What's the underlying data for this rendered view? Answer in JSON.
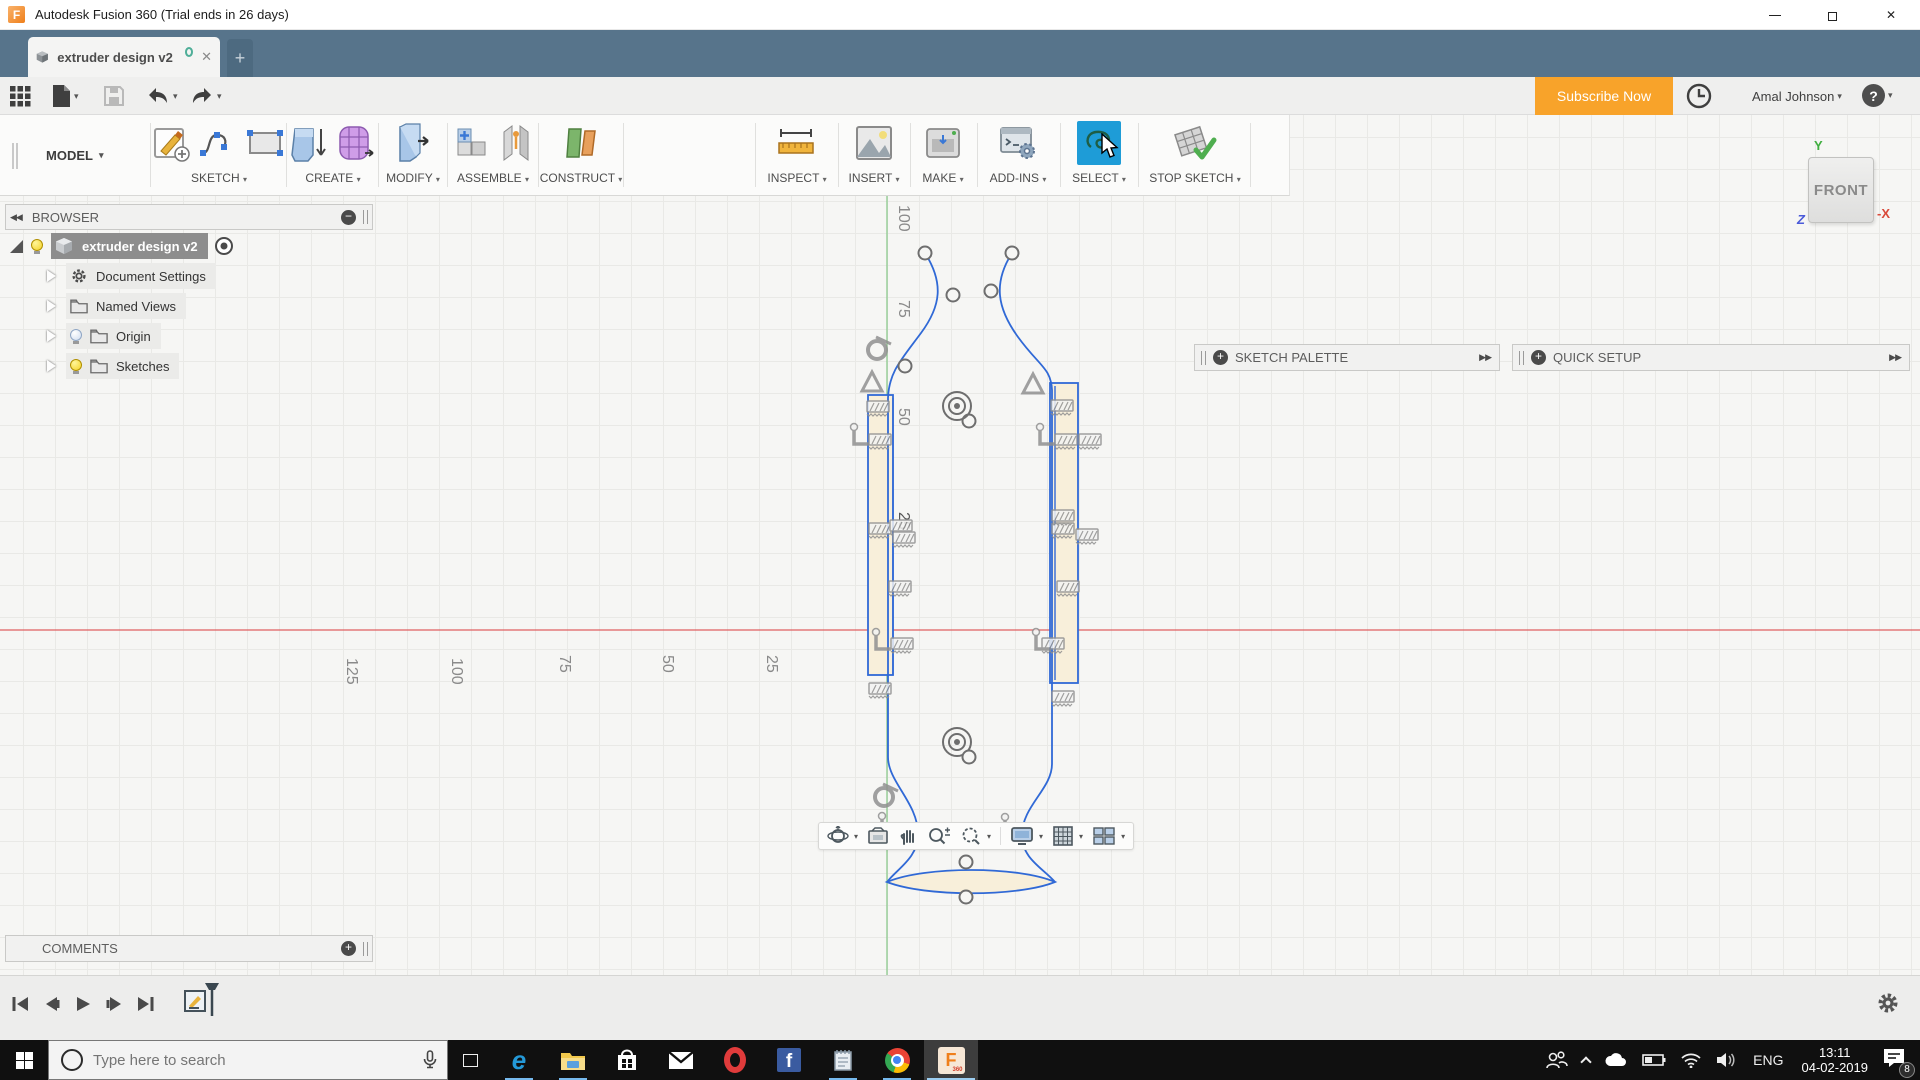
{
  "window": {
    "title": "Autodesk Fusion 360 (Trial ends in 26 days)"
  },
  "tab": {
    "title": "extruder design v2"
  },
  "header": {
    "subscribe": "Subscribe Now",
    "user": "Amal Johnson"
  },
  "ribbon": {
    "workspace": "MODEL",
    "groups": [
      {
        "label": "SKETCH"
      },
      {
        "label": "CREATE"
      },
      {
        "label": "MODIFY"
      },
      {
        "label": "ASSEMBLE"
      },
      {
        "label": "CONSTRUCT"
      },
      {
        "label": "INSPECT"
      },
      {
        "label": "INSERT"
      },
      {
        "label": "MAKE"
      },
      {
        "label": "ADD-INS"
      },
      {
        "label": "SELECT"
      },
      {
        "label": "STOP SKETCH"
      }
    ]
  },
  "browser": {
    "title": "BROWSER",
    "root_label": "extruder design v2",
    "items": [
      {
        "label": "Document Settings"
      },
      {
        "label": "Named Views"
      },
      {
        "label": "Origin"
      },
      {
        "label": "Sketches"
      }
    ]
  },
  "side_panels": {
    "sketch_palette": "SKETCH PALETTE",
    "quick_setup": "QUICK SETUP"
  },
  "comments": {
    "title": "COMMENTS"
  },
  "viewcube": {
    "face": "FRONT",
    "axis_y": "Y",
    "axis_x": "-X",
    "axis_z": "Z"
  },
  "rulers": {
    "horizontal": [
      "125",
      "100",
      "75",
      "50",
      "25"
    ],
    "vertical": [
      "100",
      "75",
      "50",
      "25"
    ],
    "occluded": "25"
  },
  "taskbar": {
    "search_placeholder": "Type here to search",
    "language": "ENG",
    "time": "13:11",
    "date": "04-02-2019",
    "notification_count": "8"
  },
  "glyphs": {
    "caret": "▾",
    "collapse": "◀◀",
    "expand": "▶▶",
    "plus": "+",
    "minus": "−",
    "close": "✕",
    "help": "?",
    "edge": "e",
    "facebook": "f",
    "opera": "O",
    "fusion": "F",
    "fusion_sub": "360"
  }
}
